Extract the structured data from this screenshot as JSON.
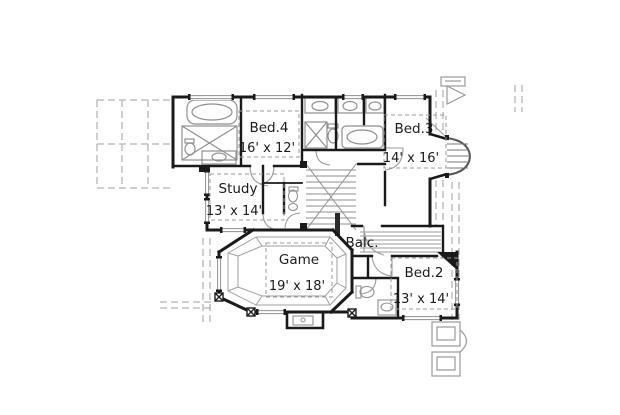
{
  "plan": {
    "rooms": [
      {
        "name": "Bed.4",
        "dims": "16' x 12'"
      },
      {
        "name": "Study",
        "dims": "13' x 14'"
      },
      {
        "name": "Bed.3",
        "dims": "14' x 16'"
      },
      {
        "name": "Game",
        "dims": "19' x 18'"
      },
      {
        "name": "Balc.",
        "dims": ""
      },
      {
        "name": "Bed.2",
        "dims": "13' x 14'"
      }
    ],
    "colors": {
      "wall": "#1a1a1a",
      "fixture": "#8f8f8f",
      "roof_dash": "#b5b5b5",
      "label_text": "#1a1a1a",
      "background": "#ffffff"
    }
  }
}
